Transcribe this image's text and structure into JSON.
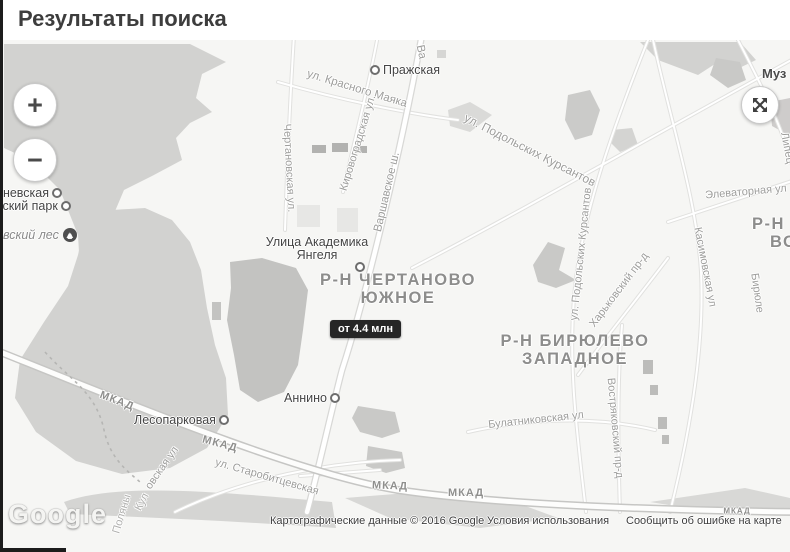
{
  "header": {
    "title": "Результаты поиска"
  },
  "controls": {
    "zoom_in": "+",
    "zoom_out": "−"
  },
  "marker": {
    "price": "от 4.4 млн"
  },
  "districts": [
    {
      "line1": "Р-Н ЧЕРТАНОВО",
      "line2": "ЮЖНОЕ"
    },
    {
      "line1": "Р-Н БИРЮЛЕВО",
      "line2": "ЗАПАДНОЕ"
    },
    {
      "line1": "Р-Н",
      "line2": "ВО"
    }
  ],
  "pois": {
    "museum": "Муз",
    "forest": "евский лес"
  },
  "metro": {
    "prazhskaya": "Пражская",
    "nevskaya": "еневская",
    "park": "вский парк",
    "akademika1": "Улица Академика",
    "akademika2": "Янгеля",
    "annino": "Аннино",
    "lesoparkovaya": "Лесопарковая"
  },
  "streets": [
    "ул. Красного Маяка",
    "Ва",
    "Варшавское ш.",
    "Чертановская ул.",
    "Кировоградская ул.",
    "ул. Подольских Курсантов",
    "ул. Подольских Курсантов",
    "Харьковский пр-д",
    "Касимовская ул",
    "Бирюле",
    "Востряковский пр-д",
    "Липец",
    "Элеваторная ул",
    "Булатниковская ул",
    "ул. Старобитцевская",
    "овская ул",
    "Поляны",
    "Кул"
  ],
  "mkad": [
    "МКАД",
    "МКАД",
    "МКАД",
    "МКАД",
    "МКАД"
  ],
  "attribution": {
    "logo": "Google",
    "copyright": "Картографические данные © 2016 Google",
    "terms": "Условия использования",
    "report": "Сообщить об ошибке на карте"
  },
  "colors": {
    "marker_bg": "#262626",
    "map_bg": "#f6f6f4",
    "area": "#d2d2d0",
    "area_dark": "#c3c3c1"
  }
}
